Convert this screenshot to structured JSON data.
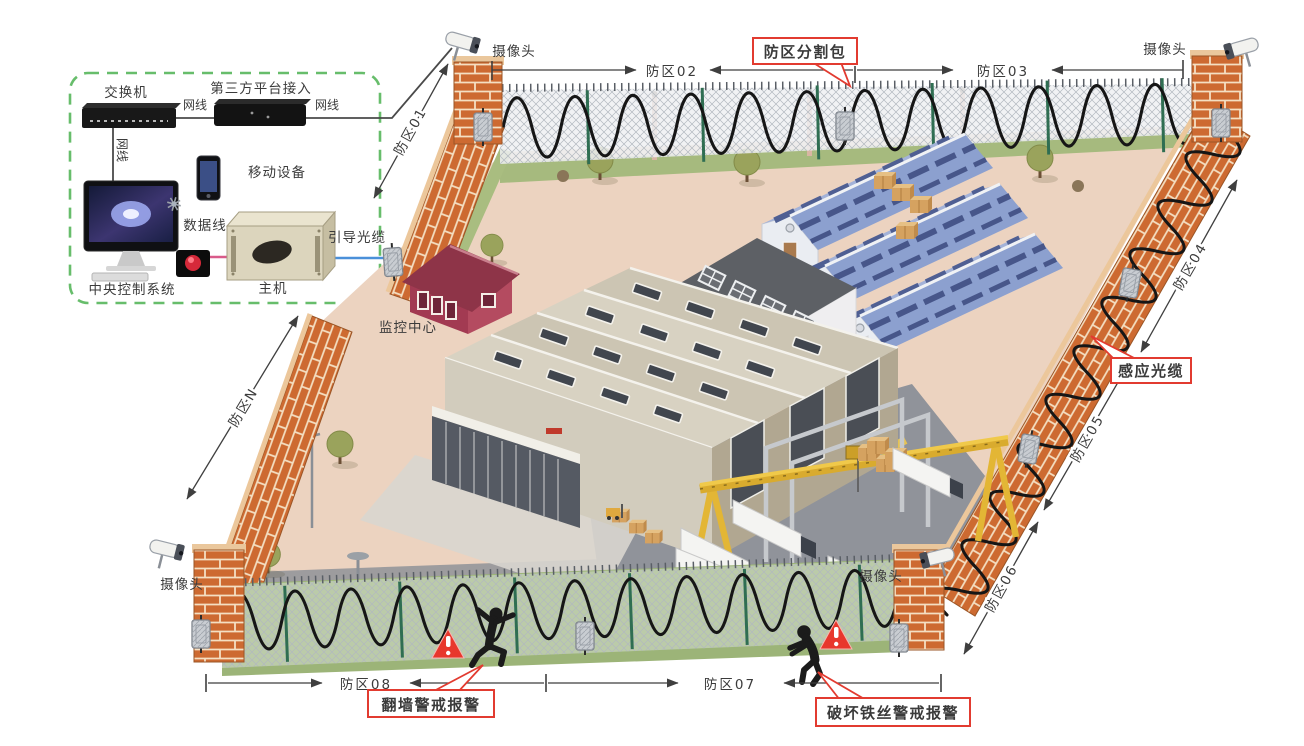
{
  "inset": {
    "switch_label": "交换机",
    "platform_label": "第三方平台接入",
    "net_cable_label_1": "网线",
    "net_cable_label_2": "网线",
    "net_cable_label_3": "网线",
    "mobile_label": "移动设备",
    "data_cable_label": "数据线",
    "central_system_label": "中央控制系统",
    "host_label": "主机",
    "guide_cable_label": "引导光缆"
  },
  "site": {
    "monitor_center_label": "监控中心",
    "camera_labels": {
      "top_left": "摄像头",
      "top_right": "摄像头",
      "bottom_left": "摄像头",
      "bottom_right": "摄像头"
    }
  },
  "zones": {
    "z01": "防区01",
    "z02": "防区02",
    "z03": "防区03",
    "z04": "防区04",
    "z05": "防区05",
    "z06": "防区06",
    "z07": "防区07",
    "z08": "防区08",
    "zN": "防区N"
  },
  "callouts": {
    "zone_splitter": "防区分割包",
    "sensing_cable": "感应光缆",
    "climb_alarm": "翻墙警戒报警",
    "cut_wire_alarm": "破坏铁丝警戒报警"
  },
  "colors": {
    "brick": "#cd6a31",
    "mortar": "#f4dfc2",
    "callout_red": "#e23b30",
    "dashed_border_green": "#67bd6b",
    "guide_cable_blue": "#4a90d9",
    "data_cable_pink": "#d95b8a",
    "sensor_cable_black": "#161616",
    "ground_pink": "#ecd3c0",
    "grass_green": "#9cb478",
    "roof_blue": "#9fb0d8"
  }
}
